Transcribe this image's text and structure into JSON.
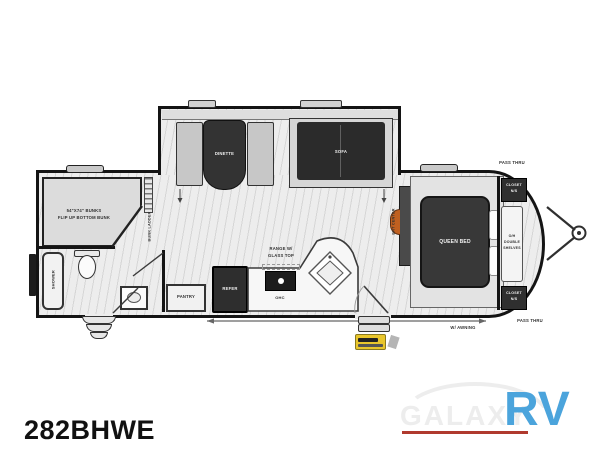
{
  "model_label": "282BHWE",
  "logo": {
    "galaxy": "GALAXY",
    "rv": "RV",
    "accent_color": "#4BA4DC",
    "underline_color": "#B03A2E",
    "galaxy_color": "#EDEDED"
  },
  "fp": {
    "bunks1": "54\"X74\" BUNKS",
    "bunks2": "FLIP UP BOTTOM BUNK",
    "bunk_ladder": "BUNK LADDER",
    "shower": "SHOWER",
    "pantry": "PANTRY",
    "refer": "REFER",
    "range1": "RANGE W/",
    "range2": "GLASS TOP",
    "ohc": "OHC",
    "dinette": "DINETTE",
    "sofa": "SOFA",
    "ent_center": "ENT CENTER",
    "queen_bed": "QUEEN BED",
    "closet1": "CLOSET",
    "closet2": "N/S",
    "shelves1": "O/H",
    "shelves2": "DOUBLE",
    "shelves3": "SHELVES",
    "pass_thru": "PASS THRU",
    "awning": "W/ AWNING",
    "badge_color": "#E9C62C",
    "fireplace_color": "#C06020"
  }
}
